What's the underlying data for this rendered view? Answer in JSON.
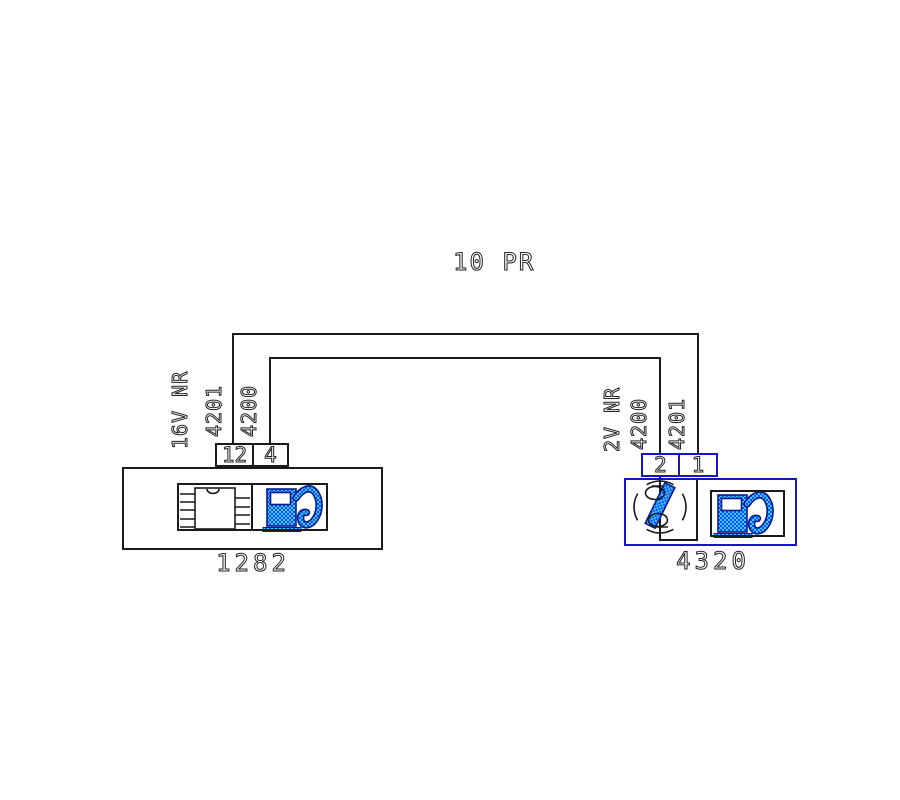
{
  "diagram": {
    "title": "10 PR"
  },
  "colors": {
    "line": "#1a1a1a",
    "accent": "#1414cd",
    "icon_outline": "#071b8f",
    "fill_blue": "#0a50f5",
    "fill_cyan": "#4ac8fa",
    "text": "#222222"
  },
  "left_component": {
    "id": "1282",
    "pins": [
      "12",
      "4"
    ],
    "wire_labels": [
      "16V NR",
      "4201",
      "4200"
    ],
    "icons": [
      "ic-chip-icon",
      "fuel-pump-icon"
    ]
  },
  "right_component": {
    "id": "4320",
    "pins": [
      "2",
      "1"
    ],
    "wire_labels": [
      "2V NR",
      "4200",
      "4201"
    ],
    "icons": [
      "level-sensor-icon",
      "fuel-pump-icon"
    ]
  },
  "wires": [
    {
      "number": "4201",
      "from_pin": "12",
      "to_pin": "1"
    },
    {
      "number": "4200",
      "from_pin": "4",
      "to_pin": "2"
    }
  ]
}
